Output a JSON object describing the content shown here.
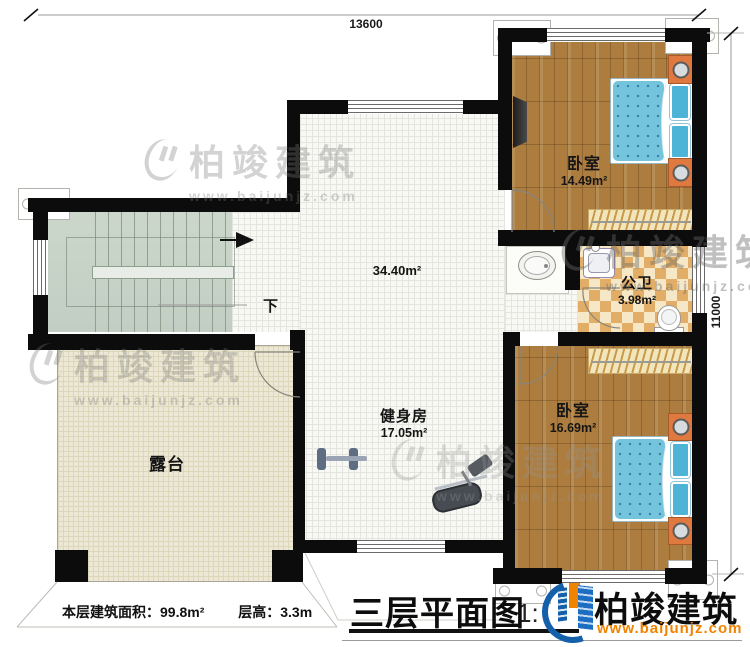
{
  "title_block": {
    "title": "三层平面图",
    "scale": "1:",
    "floor_area": "本层建筑面积：99.8m²",
    "floor_height": "层高：3.3m"
  },
  "dimensions": {
    "top": "13600",
    "right": "11000"
  },
  "rooms": [
    {
      "name": "卧室",
      "area": "14.49m²"
    },
    {
      "name": "公卫",
      "area": "3.98m²"
    },
    {
      "name": "卧室",
      "area": "16.69m²"
    },
    {
      "name": "健身房",
      "area": "17.05m²"
    },
    {
      "name": "",
      "area": "34.40m²"
    },
    {
      "name": "露台",
      "area": ""
    }
  ],
  "stairs": {
    "direction_label": "下"
  },
  "brand": {
    "name": "柏竣建筑",
    "url": "www.baijunjz.com"
  },
  "watermark": {
    "name": "柏竣建筑",
    "url": "www.baijunjz.com"
  },
  "colors": {
    "wall": "#0c0c0c",
    "wood_floor": "#ad7d3f",
    "bed_blue": "#74c4de",
    "brand_blue": "#1460aa",
    "brand_orange": "#f08300"
  }
}
